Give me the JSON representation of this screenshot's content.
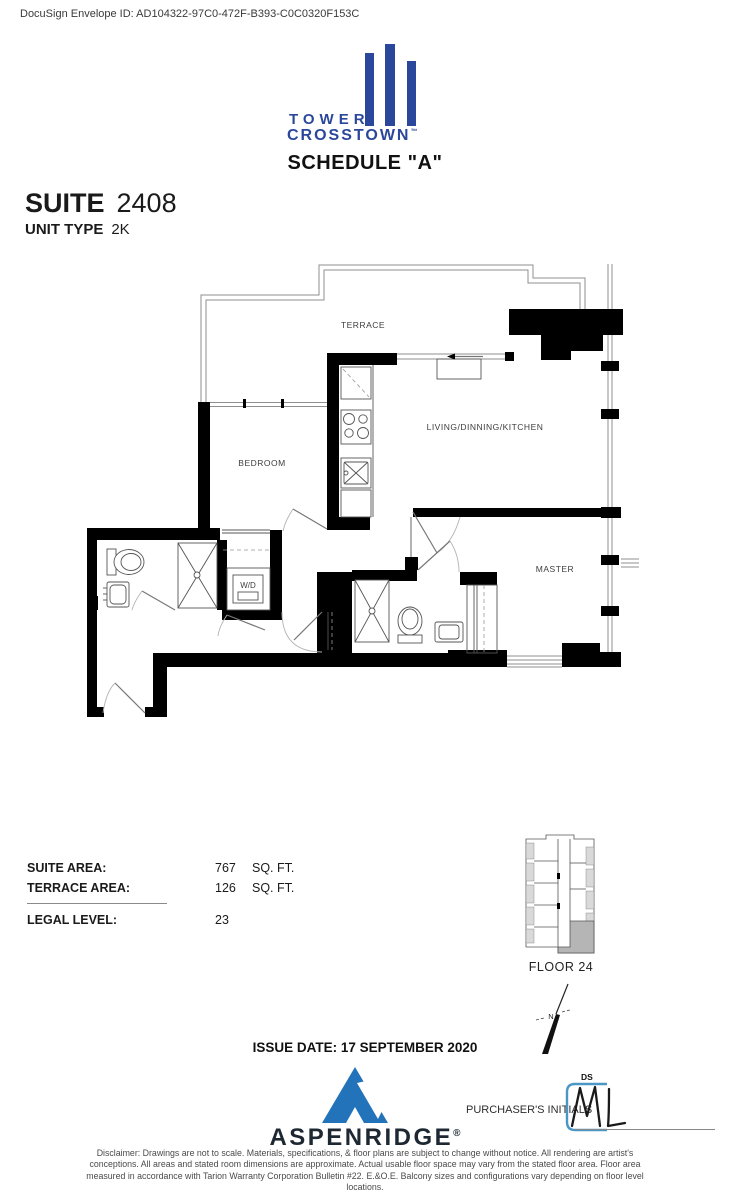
{
  "envelope_id": "DocuSign Envelope ID: AD104322-97C0-472F-B393-C0C0320F153C",
  "logo": {
    "line1": "TOWER",
    "line2": "CROSSTOWN",
    "trademark": "™"
  },
  "title": {
    "schedule": "SCHEDULE \"A\""
  },
  "suite": {
    "suite_label": "SUITE",
    "suite_number": "2408",
    "unit_type_label": "UNIT TYPE",
    "unit_type": "2K"
  },
  "plan": {
    "labels": {
      "terrace": "TERRACE",
      "living": "LIVING/DINNING/KITCHEN",
      "bedroom": "BEDROOM",
      "master": "MASTER",
      "wd": "W/D"
    }
  },
  "areas": {
    "suite_area": {
      "label": "SUITE AREA:",
      "value": "767",
      "unit": "SQ. FT."
    },
    "terrace_area": {
      "label": "TERRACE AREA:",
      "value": "126",
      "unit": "SQ. FT."
    },
    "legal_level": {
      "label": "LEGAL LEVEL:",
      "value": "23"
    }
  },
  "keyplan": {
    "floor_label": "FLOOR 24"
  },
  "north": {
    "label": "N"
  },
  "issue": {
    "date_line": "ISSUE DATE: 17 SEPTEMBER 2020"
  },
  "developer": {
    "name": "ASPENRIDGE",
    "mark": "®"
  },
  "purchaser": {
    "label": "PURCHASER'S INITIALS",
    "stamp_label": "DS",
    "initials": "ML"
  },
  "disclaimer": "Disclaimer: Drawings are not to scale. Materials, specifications, & floor plans are subject to change without notice. All rendering are artist's conceptions. All areas and stated room dimensions are approximate. Actual usable floor space may vary from the stated floor area. Floor area measured in accordance with Tarion Warranty Corporation Bulletin #22. E.&O.E. Balcony sizes and configurations vary depending on floor level locations.",
  "colors": {
    "brand_blue": "#2b479b",
    "aspen_blue": "#2273b9",
    "docusign_blue": "#4a97c6",
    "keyplan_highlight": "#b5b5b5"
  }
}
